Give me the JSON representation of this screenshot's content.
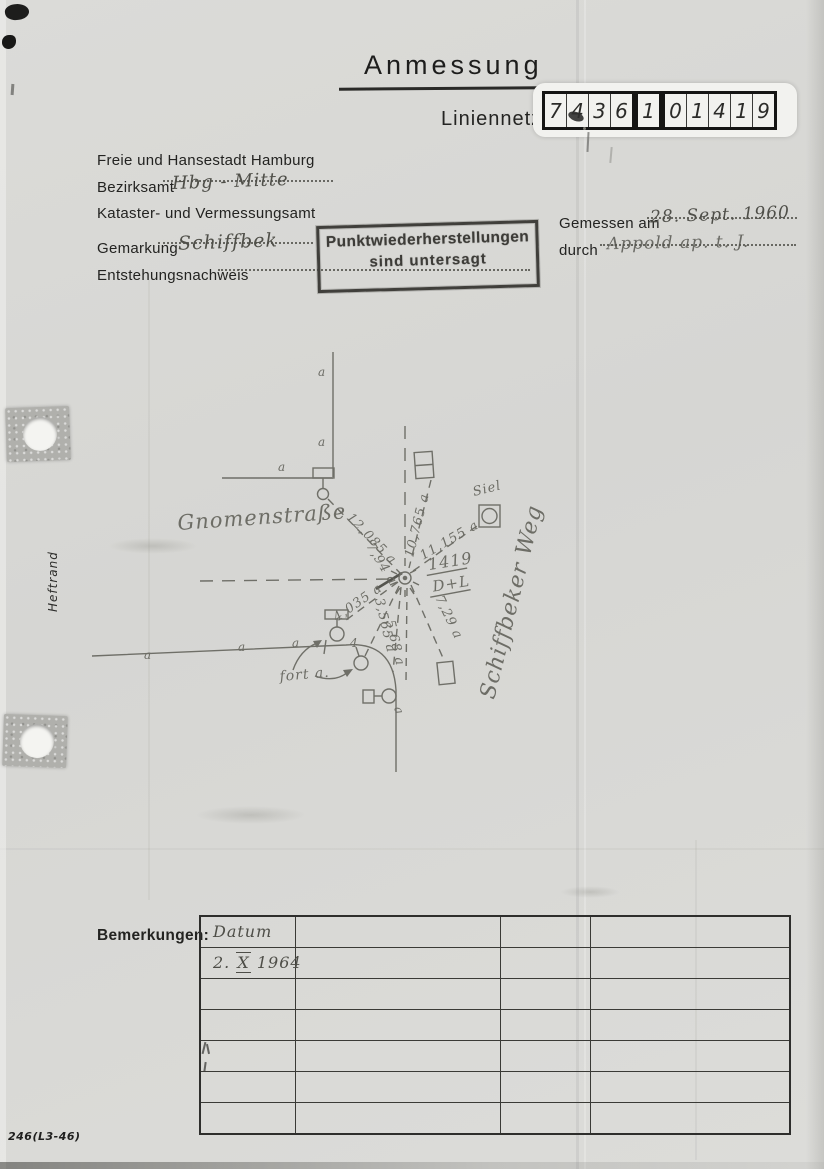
{
  "page": {
    "title": "Anmessung",
    "subtitle": "Liniennetz",
    "margin_label": "Heftrand",
    "footer_code": "246(L3-46)"
  },
  "number_box": {
    "digits": [
      "7",
      "4",
      "3",
      "6",
      "1",
      "0",
      "1",
      "4",
      "1",
      "9"
    ]
  },
  "header": {
    "agency_line1": "Freie und Hansestadt Hamburg",
    "bezirksamt_label": "Bezirksamt",
    "bezirksamt_value": "Hbg - Mitte",
    "agency_line2": "Kataster- und Vermessungsamt",
    "gemarkung_label": "Gemarkung",
    "gemarkung_value": "Schiffbek",
    "entstehung_label": "Entstehungsnachweis",
    "gemessen_label": "Gemessen am",
    "gemessen_value": "28. Sept. 1960",
    "durch_label": "durch",
    "durch_value": "Appold ap. t. J."
  },
  "stamp": {
    "line1": "Punktwiederherstellungen",
    "line2": "sind untersagt"
  },
  "sketch": {
    "street1": "Gnomenstraße",
    "street2": "Schiffbeker Weg",
    "siel_label": "Siel",
    "fort_label": "fort a.",
    "point_number": "1419",
    "point_type": "D+L",
    "measurements": [
      "12,085 a",
      "7,94 a",
      "10,765 a",
      "11,155 a",
      "7,29 a",
      "4,035 a",
      "3,565 a",
      "5,68 a"
    ],
    "marks": {
      "a": "a",
      "four": "4"
    }
  },
  "remarks": {
    "label": "Bemerkungen:",
    "col1_header": "Datum",
    "entry_date_parts": [
      "2.",
      "X",
      "1964"
    ]
  },
  "colors": {
    "paper": "#d8d8d5",
    "ink": "#232321",
    "pencil": "#6f6f68",
    "stamp_ink": "#3d3c38"
  }
}
